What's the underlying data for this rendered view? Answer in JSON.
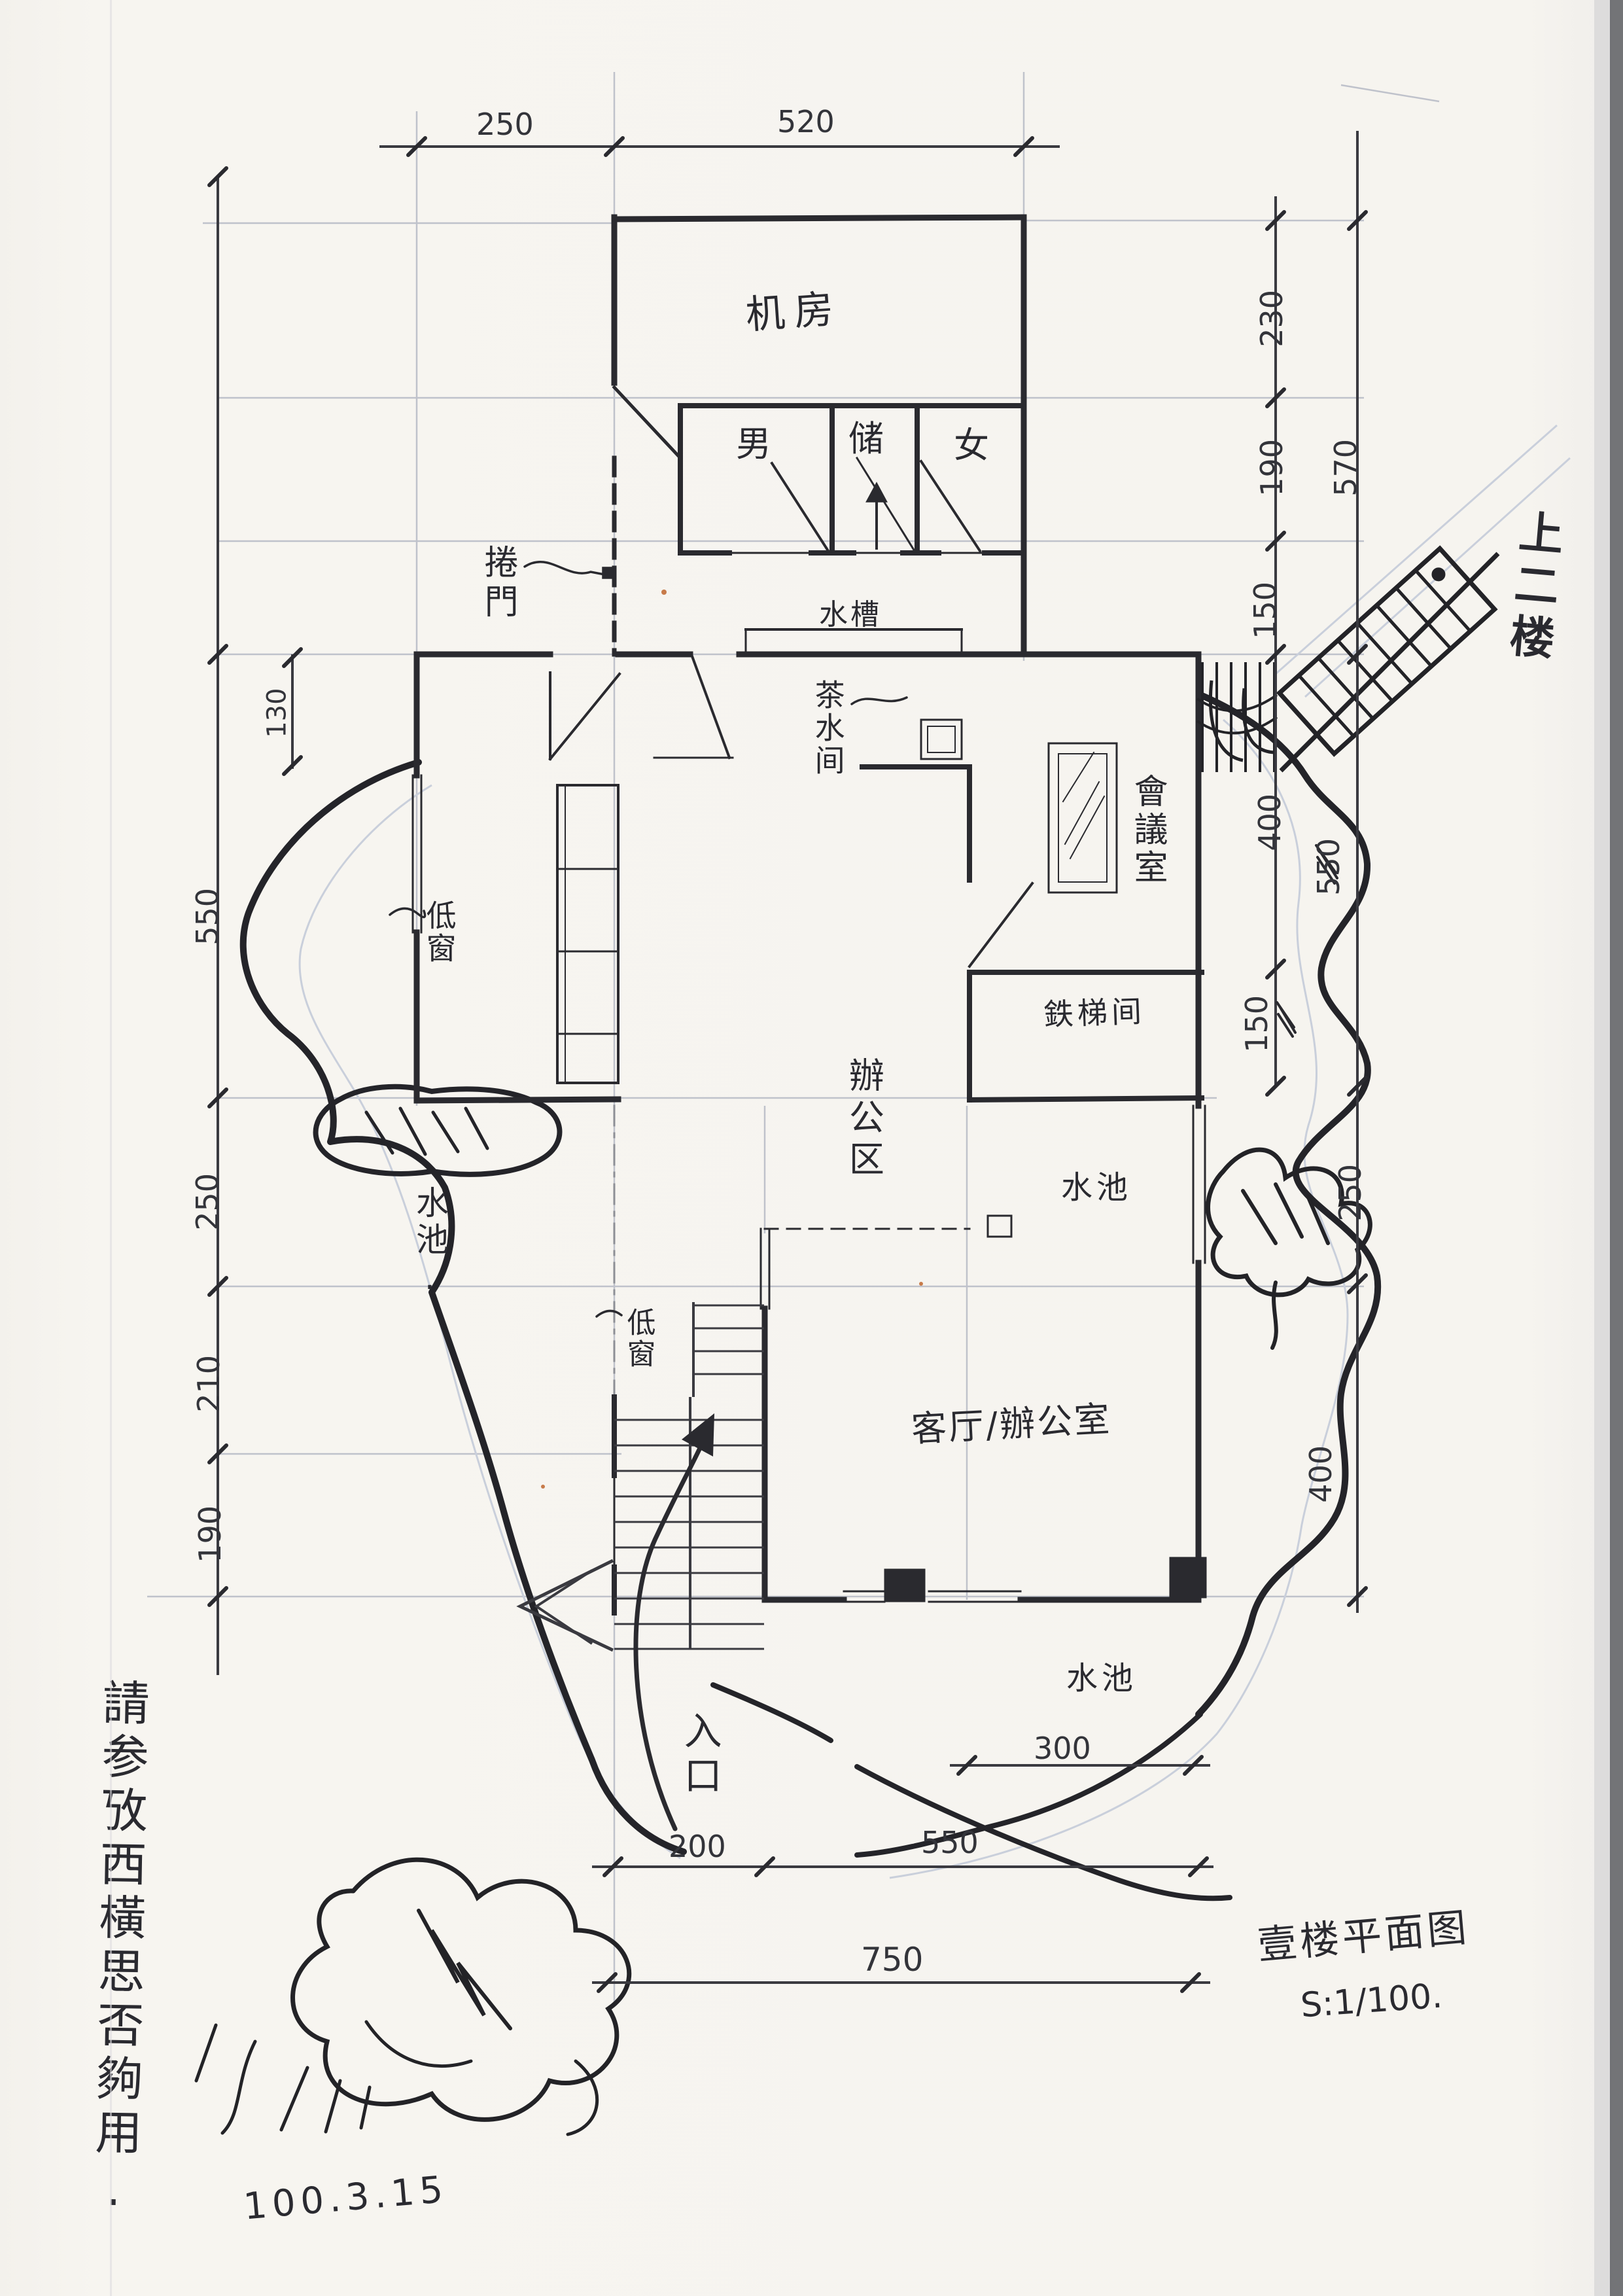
{
  "sheet": {
    "title": "壹楼平面图",
    "scale": "S:1/100.",
    "date": "100.3.15",
    "side_note": "請参攷西橫思否夠用."
  },
  "rooms": {
    "machine_room": "机房",
    "toilet_male": "男",
    "toilet_storage": "储",
    "toilet_female": "女",
    "roller_door": "捲門",
    "water_sink": "水槽",
    "tea_room": "茶水间",
    "meeting_room": "會議室",
    "iron_stair_room": "鉄梯间",
    "office_area": "辦公区",
    "low_window_left": "低窗",
    "low_window_entry": "低窗",
    "living_office": "客厅/辦公室",
    "pool_left": "水池.",
    "pool_right": "水池",
    "pool_bottom": "水池",
    "entrance": "入口",
    "up_to_2f": "上二楼"
  },
  "dims": {
    "top_250": "250",
    "top_520": "520",
    "right_230": "230",
    "right_190": "190",
    "right_150": "150",
    "right_570": "570",
    "right_400_meeting": "400",
    "right_550": "550",
    "right_150_scribble": "150",
    "right_250": "250",
    "right_400_lower": "400",
    "left_130": "130",
    "left_550": "550",
    "left_250": "250",
    "left_210": "210",
    "left_190": "190",
    "bottom_300": "300",
    "bottom_200": "200",
    "bottom_550": "550",
    "bottom_750": "750"
  }
}
